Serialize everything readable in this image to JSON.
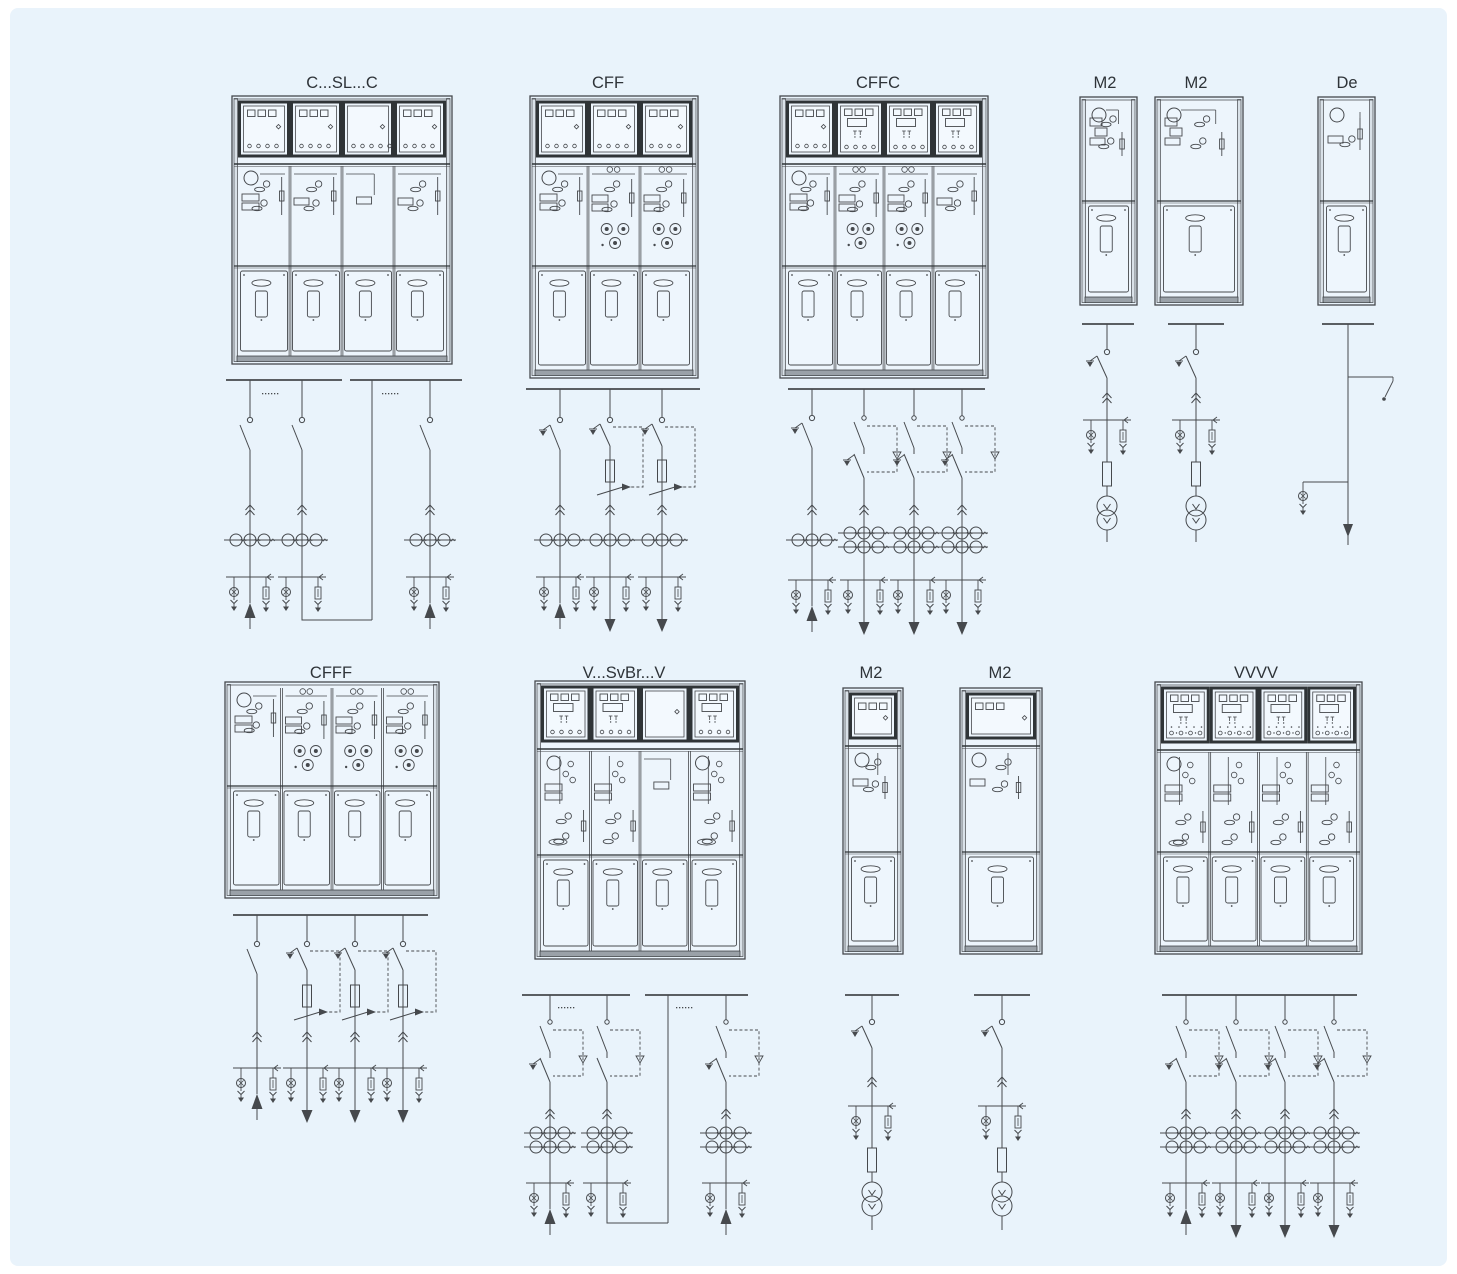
{
  "page": {
    "background": "#e9f3fb",
    "margin_color": "#ffffff",
    "line_color": "#46494d",
    "dark_color": "#2f3437",
    "panel_fill": "#eef6fd",
    "box_fill": "#f3f9fe",
    "interior_fill": "#edf5fc",
    "base_fill": "#9aa1a8",
    "label_color": "#2e3338"
  },
  "units": [
    {
      "id": "c-sl-c",
      "label": "C...SL...C",
      "label_x": 342,
      "label_y": 88,
      "cabinet": {
        "x": 232,
        "y": 96,
        "w": 220,
        "h": 268,
        "lv": 64,
        "mech": 100,
        "panels": [
          {
            "top": "squares",
            "mech": "C",
            "gauge": true
          },
          {
            "top": "squares",
            "mech": "C2"
          },
          {
            "top": "circles",
            "mech": "SL"
          },
          {
            "top": "squares",
            "mech": "C2"
          }
        ]
      },
      "schematic": {
        "y_bus": 380,
        "busbars": [
          [
            226,
            342
          ],
          [
            350,
            462
          ]
        ],
        "dots": [
          [
            262,
            393
          ],
          [
            382,
            393
          ]
        ],
        "ys": 420,
        "y_chev": 506,
        "y_ct": 533,
        "y_term": 577,
        "yfuse": 0,
        "ylsw": 0,
        "feeders": [
          {
            "type": "C",
            "x": 250,
            "earth": false,
            "arrow": "up",
            "ct": "row3"
          },
          {
            "type": "C",
            "x": 302,
            "earth": false,
            "arrow": null,
            "ct": "row3"
          },
          {
            "type": "R",
            "x": 372,
            "y2": 620
          },
          {
            "type": "C",
            "x": 430,
            "earth": false,
            "arrow": "up",
            "ct": "row3"
          }
        ],
        "links": [
          [
            [
              302,
              577
            ],
            [
              302,
              620
            ],
            [
              372,
              620
            ]
          ]
        ]
      }
    },
    {
      "id": "cff",
      "label": "CFF",
      "label_x": 608,
      "label_y": 88,
      "cabinet": {
        "x": 530,
        "y": 96,
        "w": 168,
        "h": 282,
        "lv": 64,
        "mech": 100,
        "panels": [
          {
            "top": "squares",
            "mech": "C",
            "gauge": true
          },
          {
            "top": "squares",
            "mech": "F"
          },
          {
            "top": "squares",
            "mech": "F"
          }
        ]
      },
      "schematic": {
        "y_bus": 389,
        "busbars": [
          [
            526,
            700
          ]
        ],
        "dots": [],
        "ys": 420,
        "y_chev": 506,
        "y_ct": 533,
        "y_term": 577,
        "yfuse": 460,
        "ylsw": 490,
        "feeders": [
          {
            "type": "C",
            "x": 560,
            "earth": true,
            "arrow": "up",
            "ct": "row3"
          },
          {
            "type": "F",
            "x": 610,
            "earth": true,
            "arrow": "down",
            "ct": "row3"
          },
          {
            "type": "F",
            "x": 662,
            "earth": true,
            "arrow": "down",
            "ct": "row3"
          }
        ],
        "links": []
      }
    },
    {
      "id": "cffc",
      "label": "CFFC",
      "label_x": 878,
      "label_y": 88,
      "cabinet": {
        "x": 780,
        "y": 96,
        "w": 208,
        "h": 282,
        "lv": 64,
        "mech": 100,
        "panels": [
          {
            "top": "squares",
            "mech": "C",
            "gauge": true
          },
          {
            "top": "display",
            "mech": "F"
          },
          {
            "top": "display",
            "mech": "F"
          },
          {
            "top": "display",
            "mech": "C2"
          }
        ]
      },
      "schematic": {
        "y_bus": 389,
        "busbars": [
          [
            788,
            985
          ]
        ],
        "dots": [],
        "ys": 418,
        "y_chev": 506,
        "y_ct": 533,
        "y_term": 580,
        "yfuse": 0,
        "ylsw": 0,
        "feeders": [
          {
            "type": "C",
            "x": 812,
            "earth": true,
            "arrow": "up",
            "ct": "row3"
          },
          {
            "type": "V",
            "x": 864,
            "earth": true,
            "arrow": "down",
            "ct": "dbl"
          },
          {
            "type": "V",
            "x": 914,
            "earth": true,
            "arrow": "down",
            "ct": "dbl"
          },
          {
            "type": "V",
            "x": 962,
            "earth": true,
            "arrow": "down",
            "ct": "dbl"
          }
        ],
        "links": []
      }
    },
    {
      "id": "m2-top-1",
      "label": "M2",
      "label_x": 1105,
      "label_y": 88,
      "cabinet": {
        "x": 1080,
        "y": 97,
        "w": 57,
        "h": 208,
        "lv": 0,
        "mech": 98,
        "panels": [
          {
            "top": null,
            "mech": "M",
            "gauge": true
          }
        ]
      },
      "schematic": {
        "y_bus": 324,
        "busbars": [
          [
            1082,
            1134
          ]
        ],
        "dots": [],
        "ys": 352,
        "y_chev": 394,
        "y_ct": 0,
        "y_term": 0,
        "yfuse": 0,
        "ylsw": 0,
        "feeders": [
          {
            "type": "M",
            "x": 1107,
            "earth": true,
            "ys": 352,
            "ychev": 394,
            "ybr": 420,
            "yfuse": 462,
            "ytr": 506,
            "yend": 542
          }
        ],
        "links": []
      }
    },
    {
      "id": "m2-top-2",
      "label": "M2",
      "label_x": 1196,
      "label_y": 88,
      "cabinet": {
        "x": 1155,
        "y": 97,
        "w": 88,
        "h": 208,
        "lv": 0,
        "mech": 98,
        "panels": [
          {
            "top": null,
            "mech": "M",
            "gauge": true
          }
        ]
      },
      "schematic": {
        "y_bus": 324,
        "busbars": [
          [
            1168,
            1224
          ]
        ],
        "dots": [],
        "ys": 352,
        "y_chev": 394,
        "y_ct": 0,
        "y_term": 0,
        "yfuse": 0,
        "ylsw": 0,
        "feeders": [
          {
            "type": "M",
            "x": 1196,
            "earth": true,
            "ys": 352,
            "ychev": 394,
            "ybr": 420,
            "yfuse": 462,
            "ytr": 506,
            "yend": 542
          }
        ],
        "links": []
      }
    },
    {
      "id": "de",
      "label": "De",
      "label_x": 1347,
      "label_y": 88,
      "cabinet": {
        "x": 1318,
        "y": 97,
        "w": 57,
        "h": 208,
        "lv": 0,
        "mech": 98,
        "panels": [
          {
            "top": null,
            "mech": "De",
            "gauge": true
          }
        ]
      },
      "schematic": {
        "y_bus": 324,
        "busbars": [
          [
            1322,
            1374
          ]
        ],
        "dots": [],
        "ys": 0,
        "y_chev": 0,
        "y_ct": 0,
        "y_term": 0,
        "yfuse": 0,
        "ylsw": 0,
        "feeders": [
          {
            "type": "De",
            "x": 1348,
            "ybr1": 377,
            "ybr2": 482,
            "ytip": 524,
            "yend": 545
          }
        ],
        "links": []
      }
    },
    {
      "id": "cfff",
      "label": "CFFF",
      "label_x": 331,
      "label_y": 678,
      "cabinet": {
        "x": 225,
        "y": 682,
        "w": 214,
        "h": 216,
        "lv": 0,
        "mech": 98,
        "panels": [
          {
            "top": null,
            "mech": "C",
            "gauge": true
          },
          {
            "top": null,
            "mech": "F"
          },
          {
            "top": null,
            "mech": "F"
          },
          {
            "top": null,
            "mech": "F"
          }
        ]
      },
      "schematic": {
        "y_bus": 915,
        "busbars": [
          [
            233,
            428
          ]
        ],
        "dots": [],
        "ys": 944,
        "y_chev": 1033,
        "y_ct": 0,
        "y_term": 1068,
        "yfuse": 985,
        "ylsw": 1015,
        "feeders": [
          {
            "type": "C",
            "x": 257,
            "earth": false,
            "arrow": "up",
            "ct": null
          },
          {
            "type": "F",
            "x": 307,
            "earth": true,
            "arrow": "down",
            "ct": null
          },
          {
            "type": "F",
            "x": 355,
            "earth": true,
            "arrow": "down",
            "ct": null
          },
          {
            "type": "F",
            "x": 403,
            "earth": true,
            "arrow": "down",
            "ct": null
          }
        ],
        "links": []
      }
    },
    {
      "id": "v-svbr-v",
      "label": "V...SvBr...V",
      "label_x": 624,
      "label_y": 678,
      "cabinet": {
        "x": 535,
        "y": 681,
        "w": 210,
        "h": 278,
        "lv": 64,
        "mech": 104,
        "panels": [
          {
            "top": "display",
            "mech": "V",
            "gauge": true,
            "first": true
          },
          {
            "top": "display",
            "mech": "V"
          },
          {
            "top": "empty",
            "mech": "SL"
          },
          {
            "top": "display",
            "mech": "V",
            "gauge": true,
            "first": true
          }
        ]
      },
      "schematic": {
        "y_bus": 995,
        "busbars": [
          [
            522,
            630
          ],
          [
            645,
            748
          ]
        ],
        "dots": [
          [
            558,
            1007
          ],
          [
            676,
            1007
          ]
        ],
        "ys": 1022,
        "y_chev": 1110,
        "y_ct": 1133,
        "y_term": 1183,
        "yfuse": 0,
        "ylsw": 0,
        "feeders": [
          {
            "type": "V",
            "x": 550,
            "earth": true,
            "arrow": "up",
            "ct": "dbl"
          },
          {
            "type": "V",
            "x": 607,
            "earth": false,
            "arrow": null,
            "ct": "dbl"
          },
          {
            "type": "R",
            "x": 668,
            "y2": 1223
          },
          {
            "type": "V",
            "x": 726,
            "earth": true,
            "arrow": "up",
            "ct": "dbl"
          }
        ],
        "links": [
          [
            [
              607,
              1183
            ],
            [
              607,
              1223
            ],
            [
              668,
              1223
            ]
          ]
        ]
      }
    },
    {
      "id": "m2-bottom-1",
      "label": "M2",
      "label_x": 871,
      "label_y": 678,
      "cabinet": {
        "x": 843,
        "y": 688,
        "w": 60,
        "h": 266,
        "lv": 54,
        "mech": 104,
        "panels": [
          {
            "top": "squares3",
            "mech": "M2",
            "gauge": true
          }
        ]
      },
      "schematic": {
        "y_bus": 995,
        "busbars": [
          [
            845,
            899
          ]
        ],
        "dots": [],
        "ys": 1022,
        "y_chev": 1078,
        "y_ct": 0,
        "y_term": 0,
        "yfuse": 0,
        "ylsw": 0,
        "feeders": [
          {
            "type": "M",
            "x": 872,
            "earth": true,
            "ys": 1022,
            "ychev": 1078,
            "ybr": 1106,
            "yfuse": 1148,
            "ytr": 1192,
            "yend": 1230
          }
        ],
        "links": []
      }
    },
    {
      "id": "m2-bottom-2",
      "label": "M2",
      "label_x": 1000,
      "label_y": 678,
      "cabinet": {
        "x": 960,
        "y": 688,
        "w": 82,
        "h": 266,
        "lv": 54,
        "mech": 104,
        "panels": [
          {
            "top": "squares3",
            "mech": "M2",
            "gauge": true
          }
        ]
      },
      "schematic": {
        "y_bus": 995,
        "busbars": [
          [
            974,
            1030
          ]
        ],
        "dots": [],
        "ys": 1022,
        "y_chev": 1078,
        "y_ct": 0,
        "y_term": 0,
        "yfuse": 0,
        "ylsw": 0,
        "feeders": [
          {
            "type": "M",
            "x": 1002,
            "earth": true,
            "ys": 1022,
            "ychev": 1078,
            "ybr": 1106,
            "yfuse": 1148,
            "ytr": 1192,
            "yend": 1230
          }
        ],
        "links": []
      }
    },
    {
      "id": "vvvv",
      "label": "VVVV",
      "label_x": 1256,
      "label_y": 678,
      "cabinet": {
        "x": 1155,
        "y": 682,
        "w": 207,
        "h": 272,
        "lv": 64,
        "mech": 100,
        "panels": [
          {
            "top": "vvvv",
            "mech": "V",
            "gauge": true,
            "first": true
          },
          {
            "top": "vvvv",
            "mech": "V"
          },
          {
            "top": "vvvv",
            "mech": "V"
          },
          {
            "top": "vvvv",
            "mech": "V"
          }
        ]
      },
      "schematic": {
        "y_bus": 995,
        "busbars": [
          [
            1162,
            1357
          ]
        ],
        "dots": [],
        "ys": 1022,
        "y_chev": 1110,
        "y_ct": 1133,
        "y_term": 1183,
        "yfuse": 0,
        "ylsw": 0,
        "feeders": [
          {
            "type": "V",
            "x": 1186,
            "earth": true,
            "arrow": "up",
            "ct": "dbl"
          },
          {
            "type": "V",
            "x": 1236,
            "earth": true,
            "arrow": "down",
            "ct": "dbl"
          },
          {
            "type": "V",
            "x": 1285,
            "earth": true,
            "arrow": "down",
            "ct": "dbl"
          },
          {
            "type": "V",
            "x": 1334,
            "earth": true,
            "arrow": "down",
            "ct": "dbl"
          }
        ],
        "links": []
      }
    }
  ]
}
